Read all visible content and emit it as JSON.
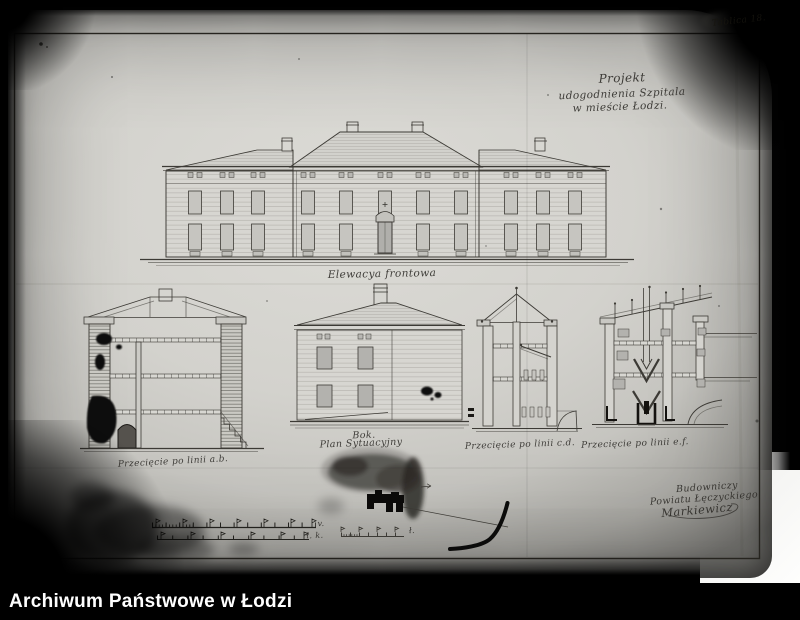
{
  "archive_bar": {
    "text": "Archiwum Państwowe w Łodzi"
  },
  "plate_number": "Tablica 18.",
  "drawing_title": {
    "line1": "Projekt",
    "line2": "udogodnienia Szpitala",
    "line3": "w mieście Łodzi."
  },
  "captions": {
    "front_elevation": "Elewacya frontowa",
    "section_ab": "Przecięcie po linii a.b.",
    "side_view": "Bok.",
    "site_plan": "Plan Sytuacyjny",
    "section_cd": "Przecięcie po linii c.d.",
    "section_ef": "Przecięcie po linii e.f."
  },
  "signature_block": {
    "line1": "Budowniczy",
    "line2": "Powiatu Łęczyckiego",
    "line3": "Markiewicz"
  },
  "scale_marks": {
    "bar1_end": "v.",
    "bar2_end": "ł. k.",
    "site_scale_end": "ł."
  },
  "colors": {
    "paper": "#d3d2cd",
    "ink": "#3c3a35",
    "background": "#000000",
    "caption_text": "#ffffff"
  }
}
